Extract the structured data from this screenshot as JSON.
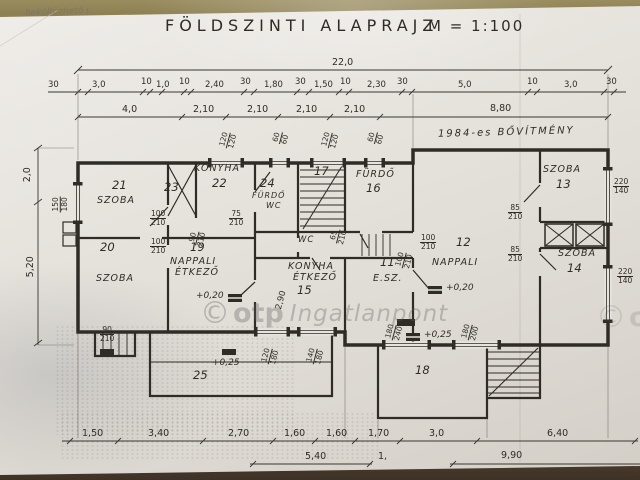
{
  "header": {
    "title": "FÖLDSZINTI ALAPRAJZ",
    "scale": "M = 1:100",
    "handwritten_note": "beköltözhető j."
  },
  "watermark": {
    "symbol": "©",
    "brand": "otp",
    "name": "Ingatlanpont"
  },
  "plan": {
    "extension_note": "1984-es BŐVÍTMÉNY",
    "rooms": [
      {
        "number": "21",
        "name": "SZOBA",
        "name2": ""
      },
      {
        "number": "23",
        "name": "",
        "name2": ""
      },
      {
        "number": "22",
        "name": "KONYHA",
        "name2": ""
      },
      {
        "number": "24",
        "name": "FÜRDŐ",
        "name2": "WC"
      },
      {
        "number": "17",
        "name": "",
        "name2": ""
      },
      {
        "number": "16",
        "name": "FÜRDŐ",
        "name2": ""
      },
      {
        "number": "13",
        "name": "SZOBA",
        "name2": ""
      },
      {
        "number": "20",
        "name": "SZOBA",
        "name2": ""
      },
      {
        "number": "19",
        "name": "NAPPALI",
        "name2": "ÉTKEZŐ"
      },
      {
        "number": "15",
        "name": "KONYHA",
        "name2": "ÉTKEZŐ"
      },
      {
        "number": "11",
        "name": "E.SZ.",
        "name2": ""
      },
      {
        "number": "12",
        "name": "NAPPALI",
        "name2": ""
      },
      {
        "number": "14",
        "name": "SZOBA",
        "name2": ""
      },
      {
        "number": "18",
        "name": "",
        "name2": ""
      },
      {
        "number": "25",
        "name": "",
        "name2": ""
      },
      {
        "number": "",
        "name": "WC",
        "name2": ""
      }
    ],
    "levels": [
      {
        "value": "+0,20"
      },
      {
        "value": "+0,20"
      },
      {
        "value": "+0,25"
      },
      {
        "value": "+0,25"
      }
    ],
    "openings": [
      {
        "w": "100",
        "h": "210"
      },
      {
        "w": "100",
        "h": "210"
      },
      {
        "w": "90",
        "h": "210"
      },
      {
        "w": "75",
        "h": "210"
      },
      {
        "w": "65",
        "h": "210"
      },
      {
        "w": "85",
        "h": "210"
      },
      {
        "w": "85",
        "h": "210"
      },
      {
        "w": "100",
        "h": "210"
      },
      {
        "w": "100",
        "h": "210"
      },
      {
        "w": "220",
        "h": "140"
      },
      {
        "w": "220",
        "h": "140"
      },
      {
        "w": "150",
        "h": "180"
      },
      {
        "w": "120",
        "h": "120"
      },
      {
        "w": "60",
        "h": "60"
      },
      {
        "w": "120",
        "h": "120"
      },
      {
        "w": "60",
        "h": "60"
      },
      {
        "w": "90",
        "h": "210"
      },
      {
        "w": "120",
        "h": "180"
      },
      {
        "w": "140",
        "h": "180"
      },
      {
        "w": "180",
        "h": "240"
      },
      {
        "w": "180",
        "h": "200"
      }
    ],
    "dims": {
      "overall": "22,0",
      "top1": [
        "30",
        "3,0",
        "10",
        "1,0",
        "10",
        "2,40",
        "30",
        "1,80",
        "30",
        "1,50",
        "10",
        "2,30",
        "30",
        "5,0",
        "10",
        "3,0",
        "30"
      ],
      "top2": [
        "4,0",
        "2,10",
        "2,10",
        "2,10",
        "2,10",
        "8,80"
      ],
      "left": [
        "2,0",
        "5,20"
      ],
      "bottom1": [
        "1,50",
        "3,40",
        "2,70",
        "1,60",
        "1,60",
        "1,70",
        "3,0",
        "6,40"
      ],
      "bottom2": [
        "5,40",
        "1,",
        "9,90"
      ],
      "interior": [
        "2,90"
      ]
    }
  }
}
